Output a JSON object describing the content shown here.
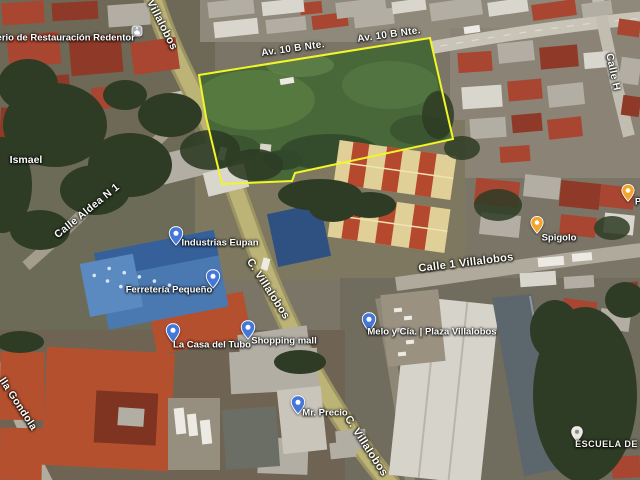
{
  "map": {
    "view_type": "satellite",
    "parcel": {
      "outline_color": "#f2f527",
      "points": "199,75 430,38 453,139 295,173 292,181 222,184 206,117"
    },
    "pin_colors": {
      "blue": "#4577d9",
      "orange": "#f2a52e",
      "white": "#ebe8e2"
    },
    "streets": [
      {
        "id": "villalobos-top",
        "name": "Villalobos",
        "x": 162,
        "y": 25,
        "rotation": 63,
        "size": 11
      },
      {
        "id": "av-10-b-nte-west",
        "name": "Av. 10 B Nte.",
        "x": 293,
        "y": 49,
        "rotation": -8,
        "size": 10
      },
      {
        "id": "av-10-b-nte-east",
        "name": "Av. 10 B Nte.",
        "x": 389,
        "y": 35,
        "rotation": -8,
        "size": 10
      },
      {
        "id": "calle-h",
        "name": "Calle H",
        "x": 613,
        "y": 72,
        "rotation": 78,
        "size": 10.5
      },
      {
        "id": "calle-aldea-n-1",
        "name": "Calle Aldea N 1",
        "x": 87,
        "y": 211,
        "rotation": -39,
        "size": 10.5
      },
      {
        "id": "c-villalobos-mid",
        "name": "C. Villalobos",
        "x": 268,
        "y": 289,
        "rotation": 57,
        "size": 11
      },
      {
        "id": "calle-1-villalobos",
        "name": "Calle 1 Villalobos",
        "x": 466,
        "y": 263,
        "rotation": -7,
        "size": 11
      },
      {
        "id": "c-villalobos-south",
        "name": "C. Villalobos",
        "x": 366,
        "y": 446,
        "rotation": 57,
        "size": 11
      },
      {
        "id": "villa-gondola",
        "name": "lla Gondola",
        "x": 18,
        "y": 404,
        "rotation": 57,
        "size": 10.5
      }
    ],
    "places": [
      {
        "id": "ministerio",
        "name": "Ministerio de Restauración Redentor",
        "label_x": 52,
        "label_y": 38,
        "icon": "church",
        "icon_x": 137,
        "icon_y": 31
      },
      {
        "id": "ismael",
        "name": "Ismael",
        "label_x": 26,
        "label_y": 160,
        "style": "locality"
      },
      {
        "id": "industrias-eupan",
        "name": "Industrias Eupan",
        "label_x": 220,
        "label_y": 243,
        "pin": "blue",
        "pin_x": 176,
        "pin_y": 236
      },
      {
        "id": "ferreteria-pequeno",
        "name": "Ferretería Pequeño",
        "label_x": 169,
        "label_y": 290,
        "pin": "blue",
        "pin_x": 213,
        "pin_y": 279
      },
      {
        "id": "la-casa-del-tubo",
        "name": "La Casa del Tubo",
        "label_x": 212,
        "label_y": 345,
        "pin": "blue",
        "pin_x": 173,
        "pin_y": 333
      },
      {
        "id": "shopping-mall",
        "name": "Shopping mall",
        "label_x": 284,
        "label_y": 341,
        "pin": "blue",
        "pin_x": 248,
        "pin_y": 330
      },
      {
        "id": "melo-y-cia",
        "name": "Melo y Cía. | Plaza Villalobos",
        "label_x": 432,
        "label_y": 332,
        "pin": "blue",
        "pin_x": 369,
        "pin_y": 322
      },
      {
        "id": "mr-precio",
        "name": "Mr. Precio",
        "label_x": 325,
        "label_y": 413,
        "pin": "blue",
        "pin_x": 298,
        "pin_y": 405
      },
      {
        "id": "spigolo",
        "name": "Spigolo",
        "label_x": 559,
        "label_y": 238,
        "pin": "orange",
        "pin_x": 537,
        "pin_y": 225
      },
      {
        "id": "poi-right-edge",
        "name": "P",
        "label_x": 638,
        "label_y": 202,
        "pin": "orange",
        "pin_x": 628,
        "pin_y": 193
      },
      {
        "id": "escuela-de-m",
        "name": "ESCUELA DE M",
        "label_x": 612,
        "label_y": 444,
        "pin": "white",
        "pin_x": 577,
        "pin_y": 434,
        "style": "caps"
      }
    ]
  }
}
